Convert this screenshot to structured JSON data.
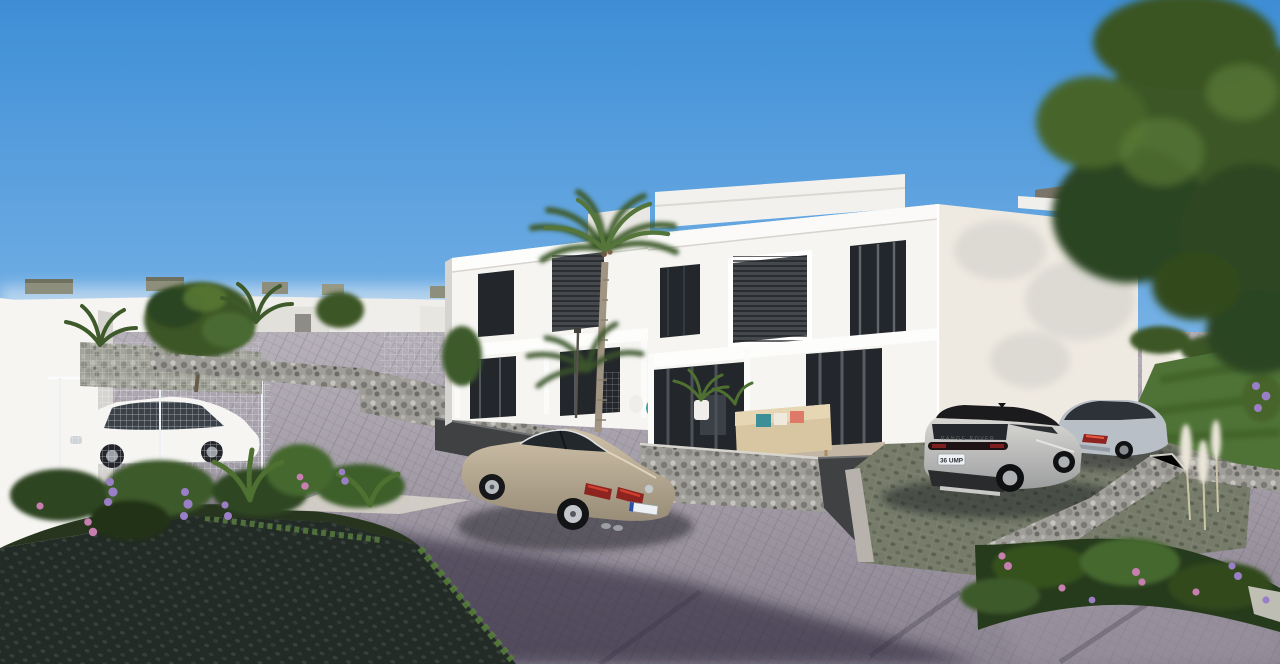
{
  "scene": {
    "title": "Modern white villa development exterior render",
    "setting": "sunny day with clear blue sky",
    "objects": [
      "two-storey white villas with flat roofs",
      "herringbone paved street",
      "grass block pavers",
      "gabion stone retaining walls",
      "wire mesh fences",
      "palm tree",
      "large green tree",
      "gardens with purple and pink flowers",
      "terrace with outdoor sofa and plant pots",
      "distant row of white houses with rooftop units"
    ]
  },
  "vehicles": {
    "sedan": {
      "label": "beige Volkswagen sedan parked on street",
      "body_color": "#b5a document"
    },
    "suv": {
      "label": "silver Range Rover SUV with black roof",
      "plate": "36 UMP",
      "tailgate_text": "RANGE ROVER",
      "body_color": "#c9c8c5"
    },
    "coupe": {
      "label": "silver coupe parked by garage",
      "body_color": "#b9bfc6"
    },
    "hatchback": {
      "label": "white hatchback behind wire fence",
      "body_color": "#eef0f2"
    }
  },
  "colors": {
    "sky_top": "#3e8ed6",
    "sky_mid": "#7ab4e7",
    "sky_horizon": "#dcebf6",
    "wall_sunlit": "#f6f5f2",
    "wall_shaded": "#d6d4d0",
    "wall_warm": "#efeae1",
    "window_dark": "#23272b",
    "louver": "#45494e",
    "road_near": "#8a8390",
    "road_far": "#b7b1ba",
    "road_shadow": "#241f31",
    "grasspaver_dark": "#2a332d",
    "driveway_green": "#767b6a",
    "gabion_base": "#a09e98",
    "dark_wall": "#3f4143",
    "tree_dark": "#2c4420",
    "tree_mid": "#3c5726",
    "tree_light": "#5a7c36",
    "lawn_green": "#4f7337",
    "flower_purple": "#9b7fc6",
    "flower_pink": "#c77fb0",
    "plume_white": "#e9e5d8",
    "vw_body": "#b9ab94",
    "velar_roof": "#1b1b1d",
    "merc_body": "#b9bfc6",
    "plate_white": "#eef1f4",
    "plate_blue": "#2a4fa8",
    "taillight_red": "#8e2420",
    "mountain": "#7e6f5d"
  }
}
